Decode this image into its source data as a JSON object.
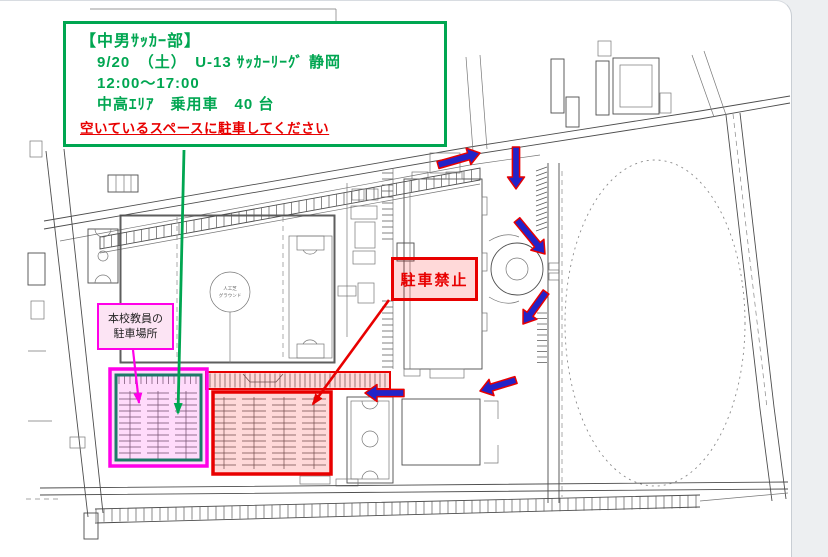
{
  "notice": {
    "title": "【中男ｻｯｶｰ部】",
    "line1": "9/20　（土）　U-13 ｻｯｶｰﾘｰｸﾞ 静岡",
    "line2": "12:00～17:00",
    "line3": "中高ｴﾘｱ　乗用車　40 台",
    "instruction": "空いているスペースに駐車してください"
  },
  "labels": {
    "no_parking": "駐車禁止",
    "teacher_parking_line1": "本校教員の",
    "teacher_parking_line2": "駐車場所",
    "ground_line1": "人工芝",
    "ground_line2": "グラウンド"
  },
  "colors": {
    "green": "#00a651",
    "red": "#e80000",
    "magenta": "#ff00e8",
    "blue_arrow": "#2323c8",
    "teal_inner": "#1c7a68",
    "pink_fill": "#fce4f4",
    "hl_red_fill": "rgba(255,0,0,0.15)",
    "hl_magenta_fill": "rgba(255,0,230,0.14)"
  }
}
